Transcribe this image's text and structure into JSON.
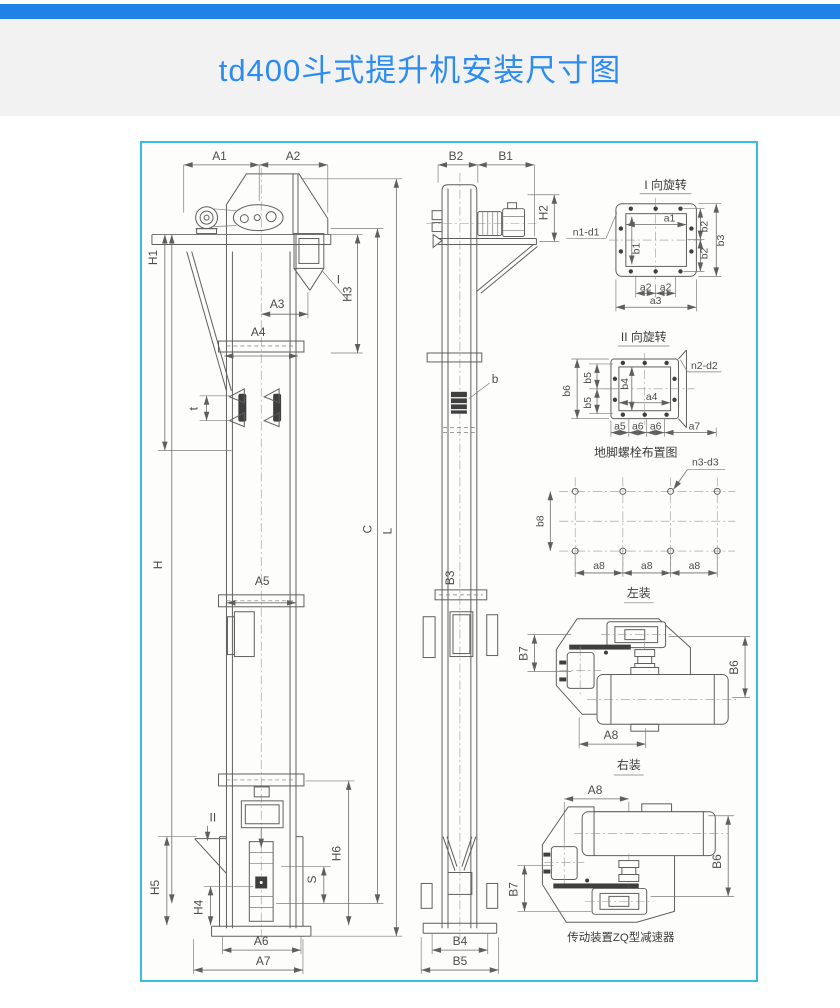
{
  "page": {
    "title": "td400斗式提升机安装尺寸图"
  },
  "colors": {
    "top_bar_blue": "#1e82e6",
    "title_blue": "#2d8cf0",
    "frame_cyan": "#35c0e3",
    "drawing_line_gray": "#5f5f5f"
  },
  "front_view": {
    "a1": "A1",
    "a2": "A2",
    "h1": "H1",
    "h": "H",
    "h3": "H3",
    "a3": "A3",
    "a4": "A4",
    "t": "t",
    "a5": "A5",
    "c": "C",
    "l": "L",
    "section_i": "I",
    "section_ii": "II",
    "h5": "H5",
    "h4": "H4",
    "s": "S",
    "h6": "H6",
    "a6": "A6",
    "a7": "A7"
  },
  "side_view": {
    "b2": "B2",
    "b1": "B1",
    "h2": "H2",
    "b": "b",
    "b3": "B3",
    "b4": "B4",
    "b5": "B5"
  },
  "detail_i": {
    "title": "I 向旋转",
    "n1d1": "n1-d1",
    "a1": "a1",
    "b1": "b1",
    "b2_upper": "b2",
    "b2_lower": "b2",
    "b3": "b3",
    "a2_left": "a2",
    "a2_right": "a2",
    "a3": "a3"
  },
  "detail_ii": {
    "title": "II 向旋转",
    "n2d2": "n2-d2",
    "b4": "b4",
    "b5_upper": "b5",
    "b5_lower": "b5",
    "b6": "b6",
    "a4": "a4",
    "a5": "a5",
    "a6_left": "a6",
    "a6_right": "a6",
    "a7": "a7"
  },
  "anchor_plan": {
    "title": "地脚螺栓布置图",
    "n3d3": "n3-d3",
    "b8": "b8",
    "a8_1": "a8",
    "a8_2": "a8",
    "a8_3": "a8"
  },
  "left_mount": {
    "title": "左装",
    "b7": "B7",
    "b6": "B6",
    "a8": "A8"
  },
  "right_mount": {
    "title": "右装",
    "a8": "A8",
    "b6": "B6",
    "b7": "B7",
    "caption": "传动装置ZQ型减速器"
  }
}
